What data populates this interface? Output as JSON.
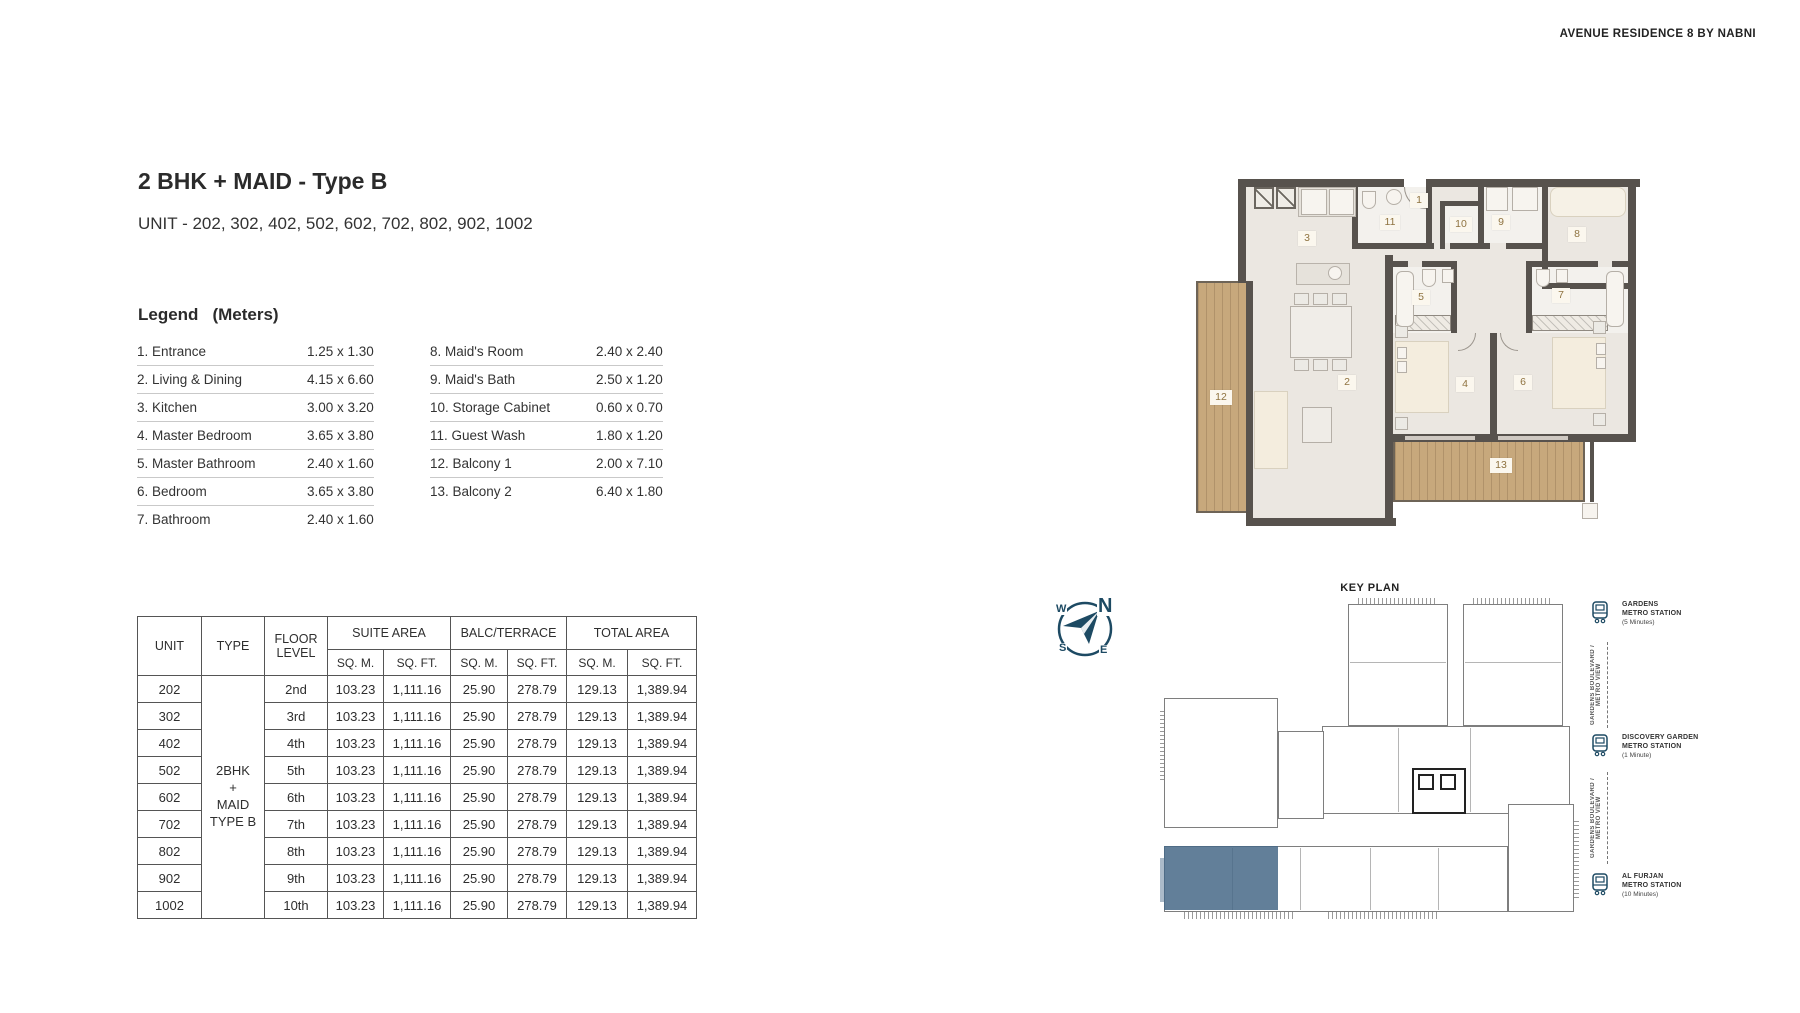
{
  "brand": "AVENUE RESIDENCE 8 BY NABNI",
  "unit_info": {
    "title": "2 BHK + MAID - Type B",
    "units_line": "UNIT - 202, 302, 402, 502, 602, 702, 802, 902, 1002"
  },
  "legend": {
    "heading": "Legend",
    "units_label": "(Meters)",
    "left": [
      {
        "name": "1. Entrance",
        "dims": "1.25 x 1.30"
      },
      {
        "name": "2. Living & Dining",
        "dims": "4.15 x 6.60"
      },
      {
        "name": "3. Kitchen",
        "dims": "3.00 x 3.20"
      },
      {
        "name": "4. Master Bedroom",
        "dims": "3.65 x 3.80"
      },
      {
        "name": "5. Master Bathroom",
        "dims": "2.40 x 1.60"
      },
      {
        "name": "6. Bedroom",
        "dims": "3.65 x 3.80"
      },
      {
        "name": "7. Bathroom",
        "dims": "2.40 x 1.60"
      }
    ],
    "right": [
      {
        "name": "8. Maid's Room",
        "dims": "2.40 x 2.40"
      },
      {
        "name": "9. Maid's Bath",
        "dims": "2.50 x 1.20"
      },
      {
        "name": "10. Storage Cabinet",
        "dims": "0.60 x 0.70"
      },
      {
        "name": "11. Guest Wash",
        "dims": "1.80 x 1.20"
      },
      {
        "name": "12. Balcony 1",
        "dims": "2.00 x 7.10"
      },
      {
        "name": "13. Balcony 2",
        "dims": "6.40 x 1.80"
      }
    ]
  },
  "area_table": {
    "col_unit": "UNIT",
    "col_type": "TYPE",
    "col_floor": "FLOOR LEVEL",
    "group_suite": "SUITE AREA",
    "group_balc": "BALC/TERRACE",
    "group_total": "TOTAL AREA",
    "sub_sqm": "SQ. M.",
    "sub_sqft": "SQ. FT.",
    "type_lines": [
      "2BHK",
      "+",
      "MAID",
      "TYPE B"
    ],
    "rows": [
      {
        "unit": "202",
        "floor": "2nd",
        "s_m": "103.23",
        "s_f": "1,111.16",
        "b_m": "25.90",
        "b_f": "278.79",
        "t_m": "129.13",
        "t_f": "1,389.94"
      },
      {
        "unit": "302",
        "floor": "3rd",
        "s_m": "103.23",
        "s_f": "1,111.16",
        "b_m": "25.90",
        "b_f": "278.79",
        "t_m": "129.13",
        "t_f": "1,389.94"
      },
      {
        "unit": "402",
        "floor": "4th",
        "s_m": "103.23",
        "s_f": "1,111.16",
        "b_m": "25.90",
        "b_f": "278.79",
        "t_m": "129.13",
        "t_f": "1,389.94"
      },
      {
        "unit": "502",
        "floor": "5th",
        "s_m": "103.23",
        "s_f": "1,111.16",
        "b_m": "25.90",
        "b_f": "278.79",
        "t_m": "129.13",
        "t_f": "1,389.94"
      },
      {
        "unit": "602",
        "floor": "6th",
        "s_m": "103.23",
        "s_f": "1,111.16",
        "b_m": "25.90",
        "b_f": "278.79",
        "t_m": "129.13",
        "t_f": "1,389.94"
      },
      {
        "unit": "702",
        "floor": "7th",
        "s_m": "103.23",
        "s_f": "1,111.16",
        "b_m": "25.90",
        "b_f": "278.79",
        "t_m": "129.13",
        "t_f": "1,389.94"
      },
      {
        "unit": "802",
        "floor": "8th",
        "s_m": "103.23",
        "s_f": "1,111.16",
        "b_m": "25.90",
        "b_f": "278.79",
        "t_m": "129.13",
        "t_f": "1,389.94"
      },
      {
        "unit": "902",
        "floor": "9th",
        "s_m": "103.23",
        "s_f": "1,111.16",
        "b_m": "25.90",
        "b_f": "278.79",
        "t_m": "129.13",
        "t_f": "1,389.94"
      },
      {
        "unit": "1002",
        "floor": "10th",
        "s_m": "103.23",
        "s_f": "1,111.16",
        "b_m": "25.90",
        "b_f": "278.79",
        "t_m": "129.13",
        "t_f": "1,389.94"
      }
    ]
  },
  "floor_plan": {
    "labels": [
      "1",
      "2",
      "3",
      "4",
      "5",
      "6",
      "7",
      "8",
      "9",
      "10",
      "11",
      "12",
      "13"
    ]
  },
  "key_plan": {
    "title": "KEY PLAN"
  },
  "compass": {
    "n": "N",
    "e": "E",
    "s": "S",
    "w": "W"
  },
  "metro": {
    "stations": [
      {
        "line1": "GARDENS",
        "line2": "METRO STATION",
        "time": "(5 Minutes)"
      },
      {
        "line1": "DISCOVERY GARDEN",
        "line2": "METRO STATION",
        "time": "(1 Minute)"
      },
      {
        "line1": "AL FURJAN",
        "line2": "METRO STATION",
        "time": "(10 Minutes)"
      }
    ],
    "corridor_label": "GARDENS BOULEVARD / METRO VIEW"
  },
  "colors": {
    "accent_navy": "#1d4a63",
    "highlight_blue": "#476987",
    "wall_dark": "#57524d",
    "wood": "#c7a87c",
    "floor_beige": "#ebe7e1",
    "label_brown": "#8f7340"
  }
}
